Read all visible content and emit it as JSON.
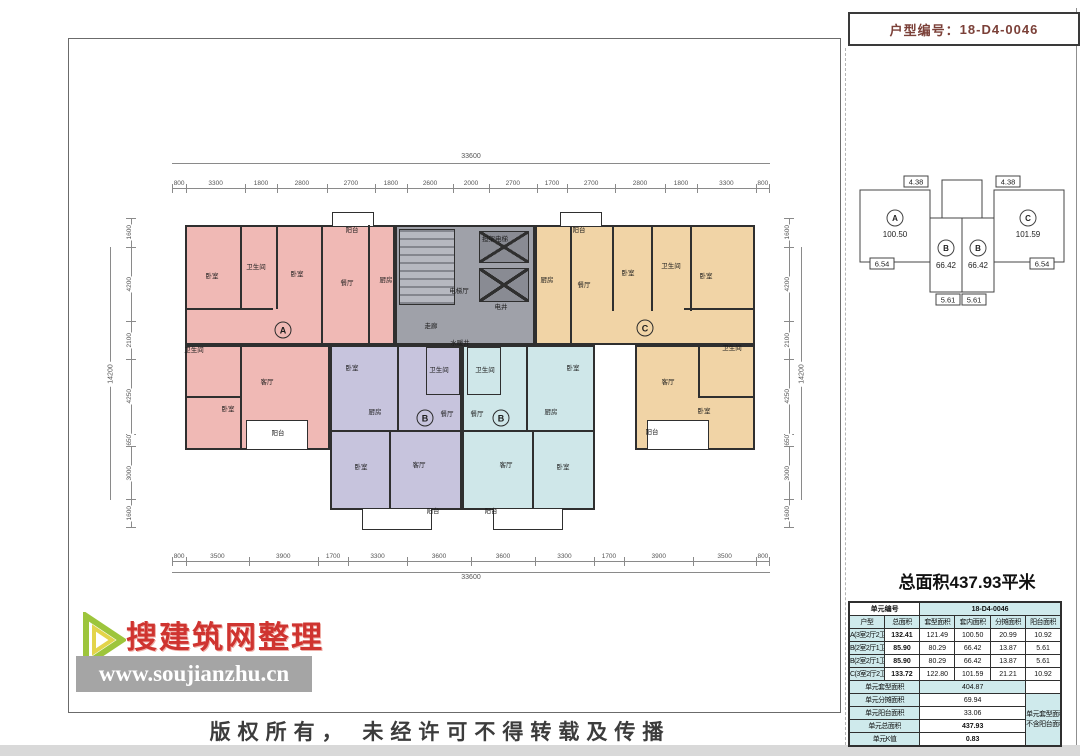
{
  "header": {
    "unit_code_label": "户型编号：",
    "unit_code": "18-D4-0046"
  },
  "key_plan": {
    "units": [
      {
        "letter": "A",
        "area": "100.50"
      },
      {
        "letter": "B",
        "area": "66.42"
      },
      {
        "letter": "B",
        "area": "66.42"
      },
      {
        "letter": "C",
        "area": "101.59"
      }
    ],
    "dims": [
      "4.38",
      "4.38",
      "6.54",
      "6.54",
      "5.61",
      "5.61"
    ]
  },
  "summary_title": "总面积437.93平米",
  "table": {
    "unit_no_label": "单元编号",
    "unit_no": "18-D4-0046",
    "headers": [
      "户型",
      "总面积",
      "套型面积",
      "套内面积",
      "分摊面积",
      "阳台面积"
    ],
    "rows": [
      [
        "A(3室2厅2卫)",
        "132.41",
        "121.49",
        "100.50",
        "20.99",
        "10.92"
      ],
      [
        "B(2室2厅1卫)",
        "85.90",
        "80.29",
        "66.42",
        "13.87",
        "5.61"
      ],
      [
        "B(2室2厅1卫)",
        "85.90",
        "80.29",
        "66.42",
        "13.87",
        "5.61"
      ],
      [
        "C(3室2厅2卫)",
        "133.72",
        "122.80",
        "101.59",
        "21.21",
        "10.92"
      ]
    ],
    "summary": [
      {
        "label": "单元套型面积",
        "value": "404.87"
      },
      {
        "label": "单元分摊面积",
        "value": "69.94"
      },
      {
        "label": "单元阳台面积",
        "value": "33.06"
      },
      {
        "label": "单元总面积",
        "value": "437.93"
      },
      {
        "label": "单元K值",
        "value": "0.83"
      }
    ],
    "note_lines": [
      "单元套型面积",
      "不含阳台面积"
    ]
  },
  "watermark": {
    "brand": "搜建筑网整理",
    "url": "www.soujianzhu.cn"
  },
  "footer": {
    "copyright": "版权所有， 未经许可不得转载及传播"
  },
  "plan": {
    "dims": {
      "top": [
        "800",
        "3300",
        "1800",
        "2800",
        "2700",
        "1800",
        "2600",
        "2000",
        "2700",
        "1700",
        "2700",
        "2800",
        "1800",
        "3300",
        "800"
      ],
      "top_total": "33600",
      "bottom": [
        "800",
        "3500",
        "3900",
        "1700",
        "3300",
        "3600",
        "3600",
        "3300",
        "1700",
        "3900",
        "3500",
        "800"
      ],
      "bottom_total": "33600",
      "left": [
        "1600",
        "4200",
        "2100",
        "4250",
        "650",
        "3000",
        "1600"
      ],
      "left_total": "14200",
      "right": [
        "1600",
        "4200",
        "2100",
        "4250",
        "650",
        "3000",
        "1600"
      ],
      "right_total": "14200"
    },
    "unit_badges": [
      {
        "letter": "A",
        "x": 283,
        "y": 330
      },
      {
        "letter": "B",
        "x": 425,
        "y": 418
      },
      {
        "letter": "B",
        "x": 501,
        "y": 418
      },
      {
        "letter": "C",
        "x": 645,
        "y": 328
      }
    ],
    "rooms": [
      {
        "label": "阳台",
        "x": 352,
        "y": 231
      },
      {
        "label": "卧室",
        "x": 212,
        "y": 277
      },
      {
        "label": "卫生间",
        "x": 256,
        "y": 268
      },
      {
        "label": "卧室",
        "x": 297,
        "y": 275
      },
      {
        "label": "餐厅",
        "x": 347,
        "y": 284
      },
      {
        "label": "厨房",
        "x": 386,
        "y": 281
      },
      {
        "label": "卫生间",
        "x": 194,
        "y": 351
      },
      {
        "label": "客厅",
        "x": 267,
        "y": 383
      },
      {
        "label": "卧室",
        "x": 228,
        "y": 410
      },
      {
        "label": "阳台",
        "x": 278,
        "y": 434
      },
      {
        "label": "卧室",
        "x": 352,
        "y": 369
      },
      {
        "label": "卫生间",
        "x": 439,
        "y": 371
      },
      {
        "label": "厨房",
        "x": 375,
        "y": 413
      },
      {
        "label": "餐厅",
        "x": 447,
        "y": 415
      },
      {
        "label": "卧室",
        "x": 361,
        "y": 468
      },
      {
        "label": "客厅",
        "x": 419,
        "y": 466
      },
      {
        "label": "阳台",
        "x": 433,
        "y": 512
      },
      {
        "label": "卫生间",
        "x": 485,
        "y": 371
      },
      {
        "label": "卧室",
        "x": 573,
        "y": 369
      },
      {
        "label": "餐厅",
        "x": 477,
        "y": 415
      },
      {
        "label": "厨房",
        "x": 551,
        "y": 413
      },
      {
        "label": "客厅",
        "x": 506,
        "y": 466
      },
      {
        "label": "卧室",
        "x": 563,
        "y": 468
      },
      {
        "label": "阳台",
        "x": 491,
        "y": 512
      },
      {
        "label": "阳台",
        "x": 579,
        "y": 231
      },
      {
        "label": "厨房",
        "x": 547,
        "y": 281
      },
      {
        "label": "餐厅",
        "x": 584,
        "y": 286
      },
      {
        "label": "卧室",
        "x": 628,
        "y": 274
      },
      {
        "label": "卫生间",
        "x": 671,
        "y": 267
      },
      {
        "label": "卧室",
        "x": 706,
        "y": 277
      },
      {
        "label": "卫生间",
        "x": 732,
        "y": 349
      },
      {
        "label": "客厅",
        "x": 668,
        "y": 383
      },
      {
        "label": "卧室",
        "x": 704,
        "y": 412
      },
      {
        "label": "阳台",
        "x": 652,
        "y": 433
      },
      {
        "label": "担架电梯",
        "x": 495,
        "y": 240
      },
      {
        "label": "电梯厅",
        "x": 459,
        "y": 292
      },
      {
        "label": "电井",
        "x": 501,
        "y": 308
      },
      {
        "label": "走廊",
        "x": 431,
        "y": 327
      },
      {
        "label": "水暖井",
        "x": 460,
        "y": 344
      }
    ],
    "colors": {
      "unit_a": "#f0b9b5",
      "unit_b_left": "#c7c4dd",
      "unit_b_right": "#cfe7e9",
      "unit_c": "#f1d4a6",
      "core": "#9fa1a9",
      "table_accent": "#cfeaec"
    }
  }
}
